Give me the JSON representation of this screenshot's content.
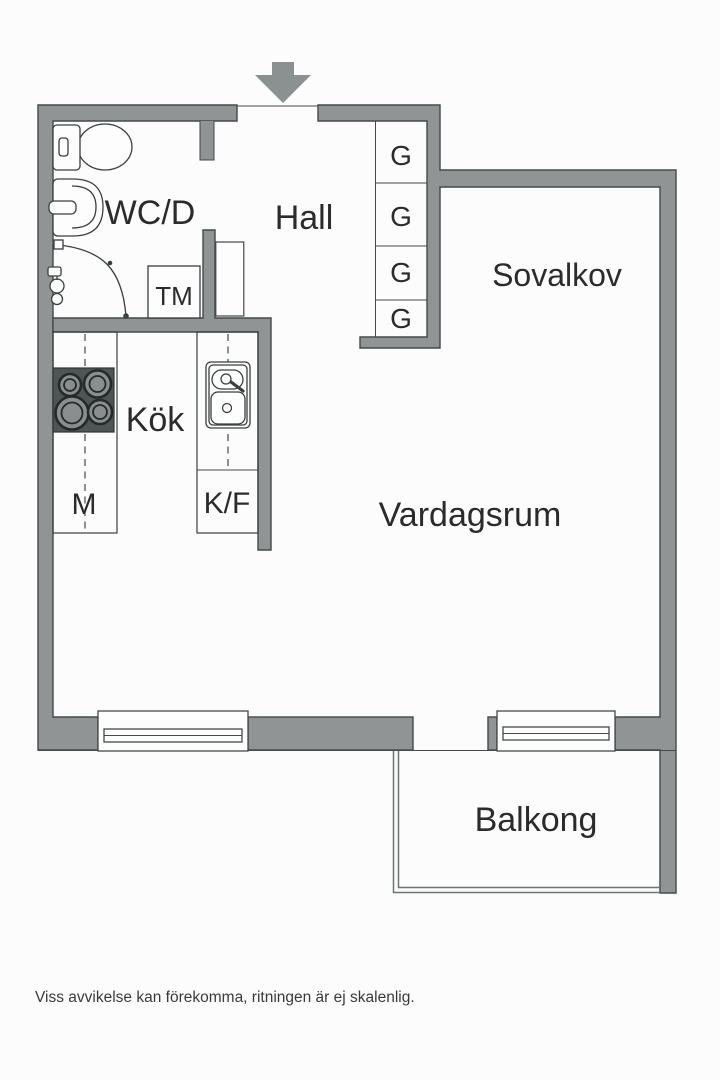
{
  "plan": {
    "title_hint": "apartment floor plan",
    "rooms": {
      "wc": {
        "label": "WC/D"
      },
      "hall": {
        "label": "Hall"
      },
      "sovalkov": {
        "label": "Sovalkov"
      },
      "kok": {
        "label": "Kök"
      },
      "vardagsrum": {
        "label": "Vardagsrum"
      },
      "balkong": {
        "label": "Balkong"
      }
    },
    "fixtures": {
      "tm": {
        "label": "TM"
      },
      "m": {
        "label": "M"
      },
      "kf": {
        "label": "K/F"
      },
      "wardrobes": [
        {
          "label": "G"
        },
        {
          "label": "G"
        },
        {
          "label": "G"
        },
        {
          "label": "G"
        }
      ]
    },
    "disclaimer": "Viss avvikelse kan förekomma, ritningen är ej skalenlig.",
    "colors": {
      "wall": "#909494",
      "wall_outline": "#44494a",
      "stove": "#4f5454",
      "burner_center": "#8a8e8e",
      "text": "#2b2b2b",
      "railing": "#6f7474",
      "background": "#fcfcfc"
    }
  }
}
